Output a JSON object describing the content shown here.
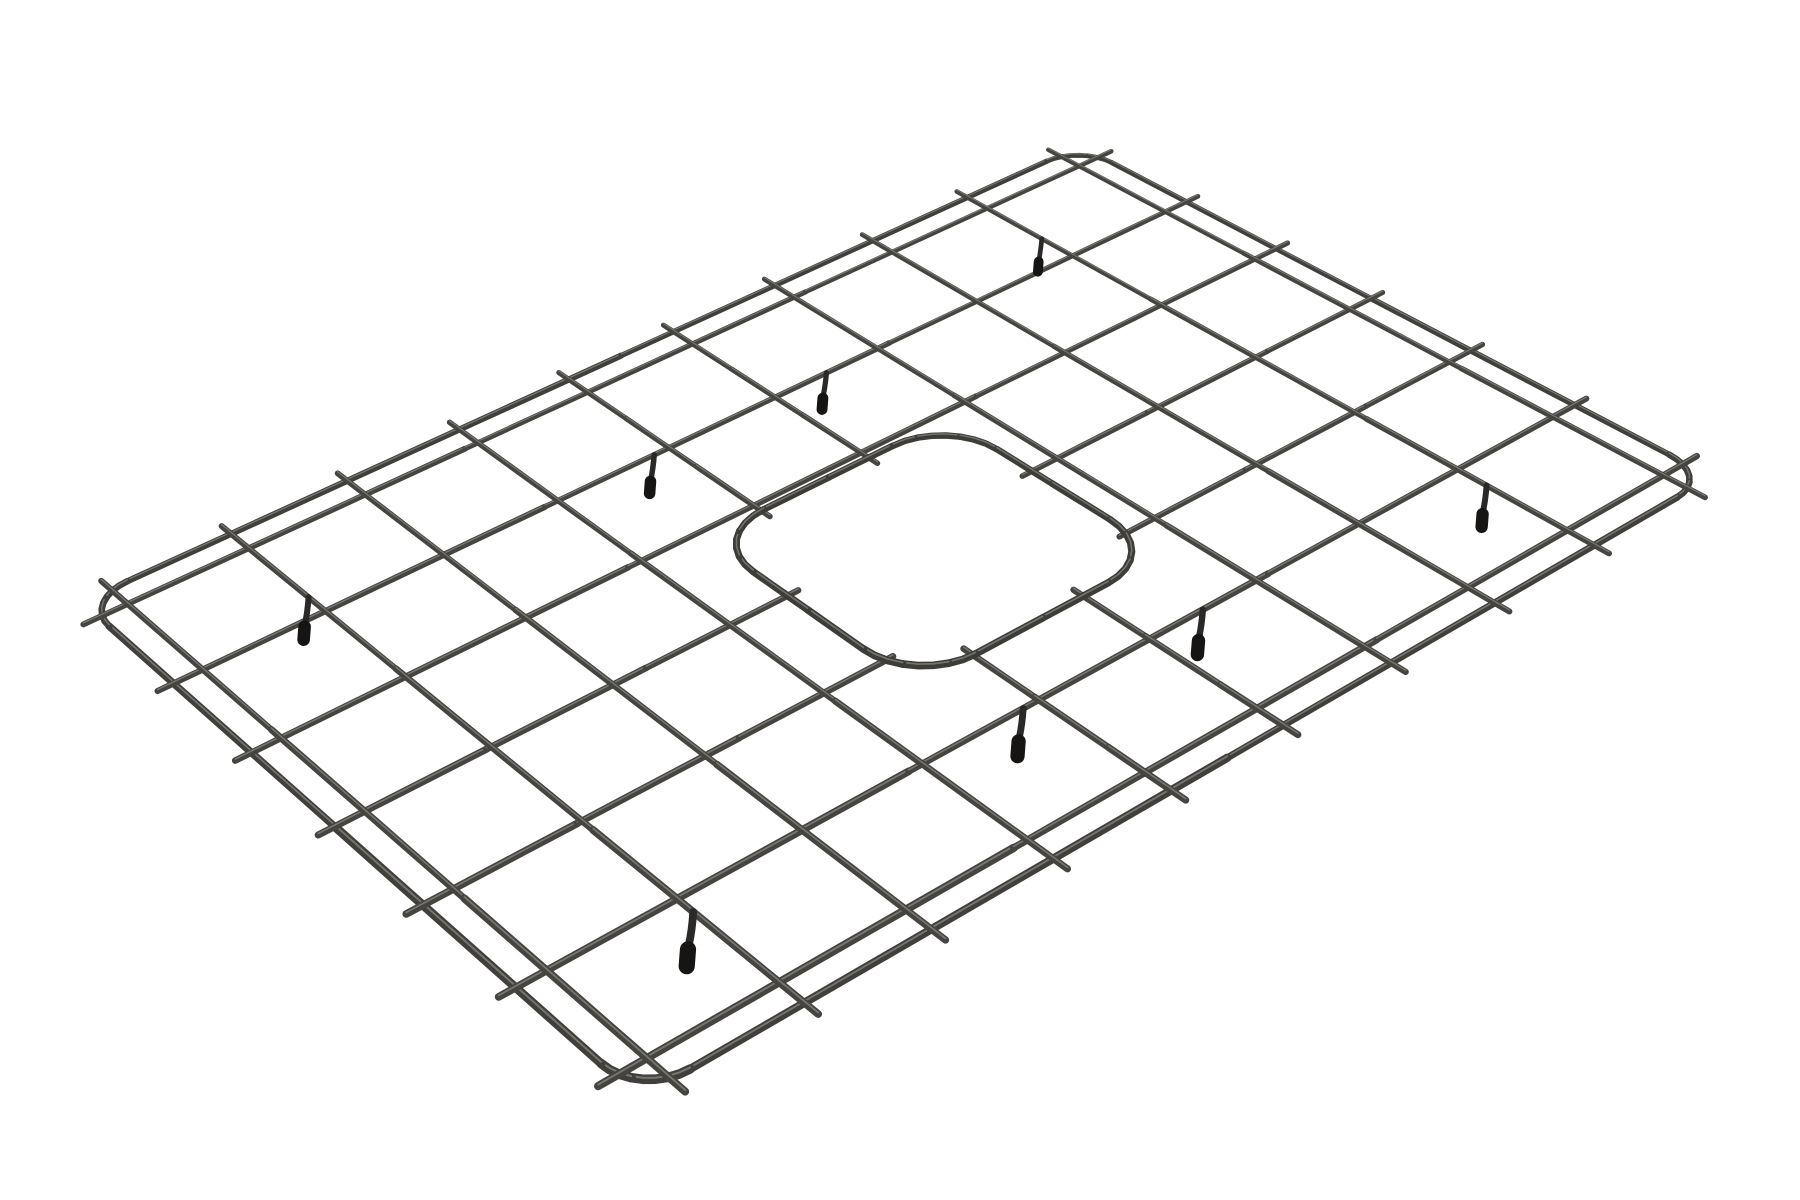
{
  "image": {
    "type": "product-render",
    "subject": "rectangular wire sink bottom grid with rounded corners, center drain cutout and rubber feet",
    "background_color": "#ffffff"
  },
  "object": {
    "wire_color": "#454440",
    "wire_highlight_color": "#a3a29b",
    "frame_color": "#403f3c",
    "cutout_ring_color": "#3d3c39",
    "foot_leg_color": "#2a2927",
    "foot_tip_color": "#161514",
    "grid_columns": 9,
    "grid_rows": 6,
    "transverse_wire_count": 10,
    "longitudinal_wire_count": 7,
    "feet_count": 8,
    "corners_px": {
      "left": [
        82,
        602
      ],
      "top": [
        1080,
        146
      ],
      "right": [
        1712,
        477
      ],
      "bottom": [
        640,
        1098
      ]
    },
    "frame_corner_radius": 0.35,
    "wire_overhang": 0.12,
    "transverse_u": [
      0.22,
      1.17,
      2.12,
      3.07,
      4.03,
      4.98,
      5.93,
      6.88,
      7.83,
      8.78
    ],
    "longitudinal_v": [
      0.22,
      1.15,
      2.07,
      3.0,
      3.93,
      4.85,
      5.78
    ],
    "cutout": {
      "u_range": [
        3.55,
        5.7
      ],
      "v_range": [
        2.15,
        4.25
      ],
      "corner_radius": 0.5,
      "stub_overshoot": 0.09
    },
    "feet": [
      {
        "u": 1.17,
        "v": 0.95
      },
      {
        "u": 7.83,
        "v": 0.82
      },
      {
        "u": 1.17,
        "v": 5.0
      },
      {
        "u": 7.83,
        "v": 5.1
      },
      {
        "u": 3.9,
        "v": 1.15
      },
      {
        "u": 5.45,
        "v": 1.15
      },
      {
        "u": 3.9,
        "v": 4.85
      },
      {
        "u": 5.45,
        "v": 4.85
      }
    ],
    "stroke_px": {
      "wire": 6.0,
      "frame": 6.6,
      "ring": 7.0,
      "foot_leg": 6.0,
      "foot_tip": 12.5
    }
  }
}
